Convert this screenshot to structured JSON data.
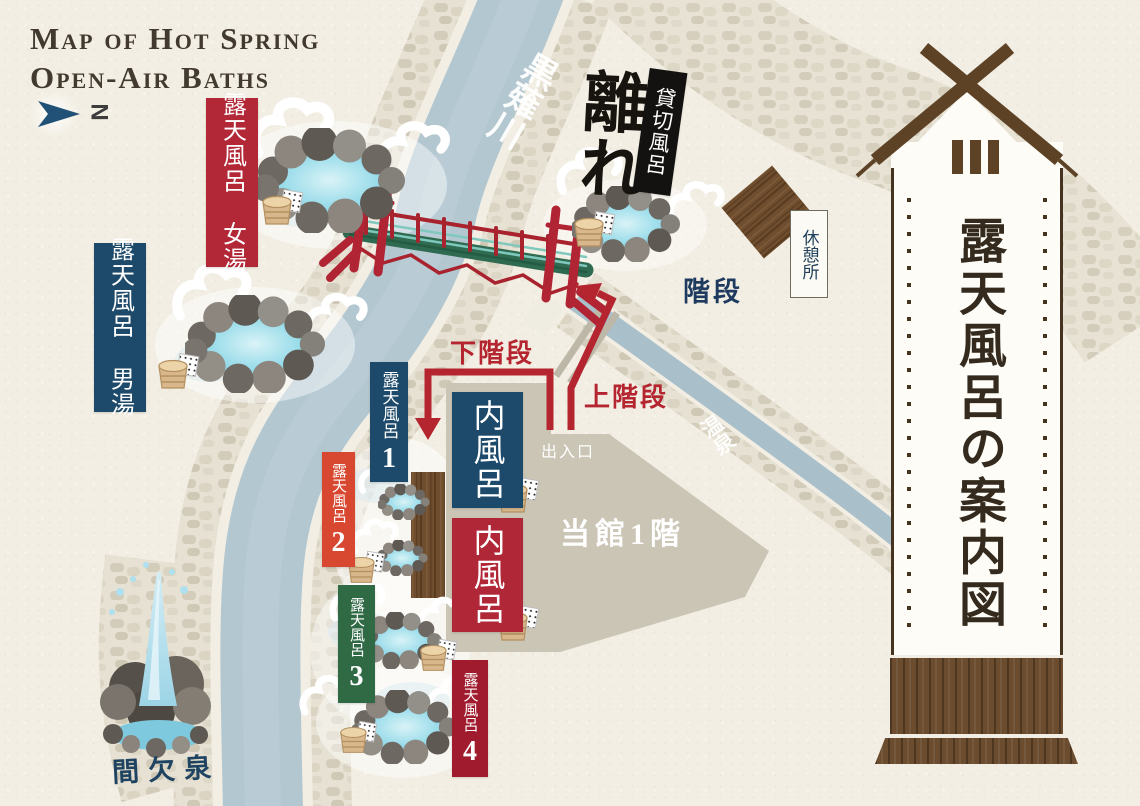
{
  "map_title": {
    "line1": "Map of Hot Spring",
    "line2": "Open-Air Baths"
  },
  "compass": {
    "north_label": "N"
  },
  "sign_board": {
    "title": "露天風呂の案内図"
  },
  "river": {
    "name": "黒薙川"
  },
  "stream": {
    "name": "温泉"
  },
  "areas": {
    "women_bath": "露天風呂 女湯",
    "men_bath": "露天風呂 男湯",
    "hanare": "離れ",
    "private_bath": "貸切風呂",
    "rest_area": "休憩所",
    "stairs": "階段",
    "down_stairs": "下階段",
    "up_stairs": "上階段",
    "entrance": "出入口",
    "building_floor": "当館1階",
    "indoor_bath": "内風呂",
    "geyser": "間欠泉"
  },
  "outdoor_baths": [
    {
      "label": "露天風呂",
      "number": "1",
      "color": "#1d4a6a"
    },
    {
      "label": "露天風呂",
      "number": "2",
      "color": "#d8472f"
    },
    {
      "label": "露天風呂",
      "number": "3",
      "color": "#2f6a45"
    },
    {
      "label": "露天風呂",
      "number": "4",
      "color": "#a01b2d"
    }
  ],
  "colors": {
    "paper": "#f2eee3",
    "river_water": "#b3c7d1",
    "label_red": "#b22837",
    "label_blue": "#1d4a6a",
    "label_orange": "#d8472f",
    "label_green": "#2f6a45",
    "label_dark_red": "#a01b2d",
    "indoor_red": "#b02737",
    "path_red": "#b5252f",
    "text_navy": "#1e3a5f",
    "building_gray": "#cbc5b5",
    "wood_brown": "#6b4c2e",
    "sign_text": "#342a1d"
  }
}
